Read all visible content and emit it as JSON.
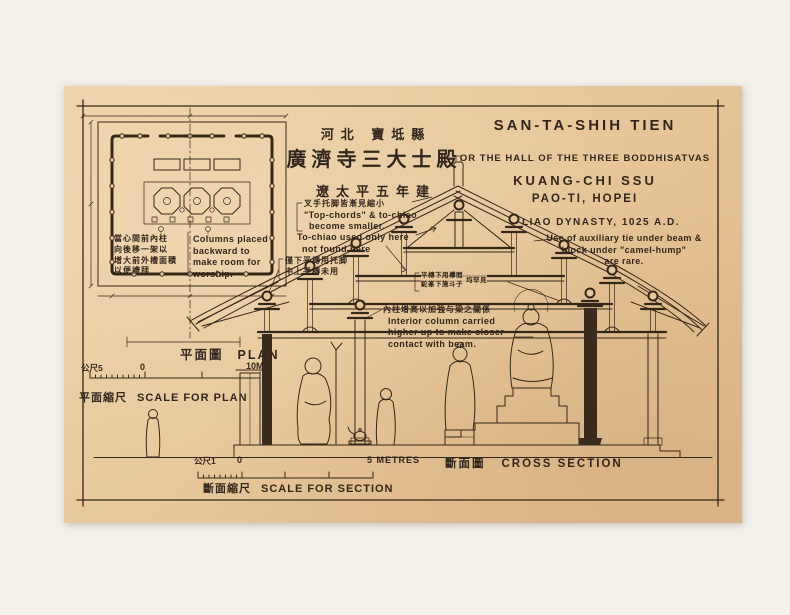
{
  "page": {
    "background": "#f3f0ea",
    "paper_color": "#e8c79c",
    "ink_color": "#352718"
  },
  "title_cn": {
    "region": "河北 寶坻縣",
    "hall": "廣濟寺三大士殿",
    "dynasty": "遼太平五年建"
  },
  "title_en": {
    "main": "SAN-TA-SHIH TIEN",
    "sub": "OR THE HALL OF THE THREE BODDHISATVAS",
    "temple": "KUANG-CHI SSU",
    "place": "PAO-TI, HOPEI",
    "dynasty": "LIAO DYNASTY, 1025 A.D."
  },
  "plan": {
    "label_cn": "平面圖",
    "label_en": "PLAN",
    "note_cn": [
      "當心間前內柱",
      "向後移一架以",
      "增大前外槽面積",
      "以便禮拜"
    ],
    "note_en": [
      "Columns placed",
      "backward to",
      "make room for",
      "worship."
    ],
    "scale": {
      "metric_label": "公尺5",
      "zero": "0",
      "max_label": "10M.",
      "caption_cn": "平面縮尺",
      "caption_en": "SCALE FOR PLAN"
    }
  },
  "section": {
    "label_cn": "斷面圖",
    "label_en": "CROSS SECTION",
    "scale": {
      "metric_label": "公尺1",
      "zero": "0",
      "max_label": "5 METRES",
      "caption_cn": "斷面縮尺",
      "caption_en": "SCALE FOR SECTION"
    },
    "notes": {
      "top_chord_cn": "叉手托脚皆漸見縮小",
      "top_chord_en1": "\"Top-chords\" & to-chiao",
      "top_chord_en2": "become smaller.",
      "tochiao_en1": "To-chiao used only here",
      "tochiao_en2": "not found here",
      "tochiao_cn1": "僅下平槫用托脚",
      "tochiao_cn2": "中上平槫未用",
      "panjian_cn1": "平槫下用襻間",
      "panjian_cn2": "駝峯下施斗子",
      "panjian_cn3": "均罕見",
      "column_cn": "內柱增高以加強与梁之關係",
      "column_en1": "Interior column carried",
      "column_en2": "higher up to make closer",
      "column_en3": "contact with beam.",
      "tie_en1": "Use of auxiliary tie under beam &",
      "tie_en2": "block under \"camel-hump\"",
      "tie_en3": "are rare."
    }
  }
}
